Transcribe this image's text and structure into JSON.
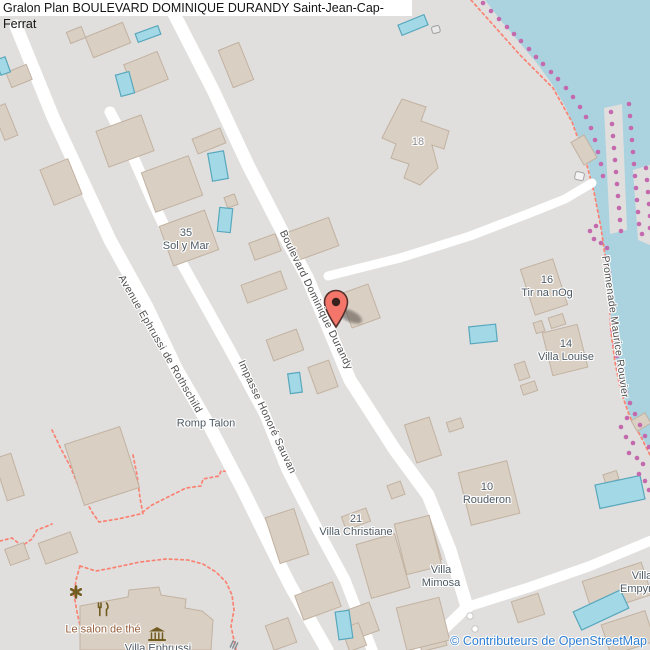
{
  "title": "Gralon Plan BOULEVARD DOMINIQUE DURANDY Saint-Jean-Cap-Ferrat",
  "attribution": "© Contributeurs de OpenStreetMap",
  "colors": {
    "land": "#e0dfdd",
    "water": "#aad3df",
    "road": "#ffffff",
    "building": "#d9cfc3",
    "building_stroke": "#c2b2a1",
    "pool": "#a3d9e6",
    "pool_stroke": "#58a7bd",
    "path": "#fa8273",
    "coast_dot": "#c469ae",
    "marker": "#f4766b",
    "marker_stroke": "#54302b",
    "marker_hole": "#38211d",
    "street_label": "#4f4f4f",
    "place_label": "#4e5a64",
    "housenumber_label": "#8e8e8e",
    "amenity_label": "#96603d",
    "amenity_icon": "#715c22",
    "attribution_text": "#2d7dd2",
    "title_text": "#141414",
    "title_bg": "#ffffff"
  },
  "streets": [
    {
      "name": "Boulevard Dominique Durandy"
    },
    {
      "name": "Avenue Ephrussi de Rothschild"
    },
    {
      "name": "Impasse Honoré Sauvan"
    },
    {
      "name": "Promenade Maurice Rouvier"
    }
  ],
  "places": [
    {
      "line1": "35",
      "line2": "Sol y Mar"
    },
    {
      "line1": "18",
      "line2": ""
    },
    {
      "line1": "16",
      "line2": "Tir na nOg"
    },
    {
      "line1": "14",
      "line2": "Villa Louise"
    },
    {
      "line1": "10",
      "line2": "Rouderon"
    },
    {
      "line1": "21",
      "line2": "Villa Christiane"
    },
    {
      "line1": "Romp Talon",
      "line2": ""
    },
    {
      "line1": "Villa",
      "line2": "Mimosa"
    },
    {
      "line1": "Villa",
      "line2": "Empyrée"
    },
    {
      "line1": "Villa Ephrussi",
      "line2": ""
    }
  ],
  "amenities": [
    {
      "icon": "restaurant-icon",
      "line1": "Le salon",
      "line2": "de thé"
    },
    {
      "icon": "museum-icon",
      "line1": "",
      "line2": ""
    },
    {
      "icon": "attraction-icon",
      "line1": "",
      "line2": ""
    }
  ],
  "marker": {
    "type": "map-pin"
  }
}
